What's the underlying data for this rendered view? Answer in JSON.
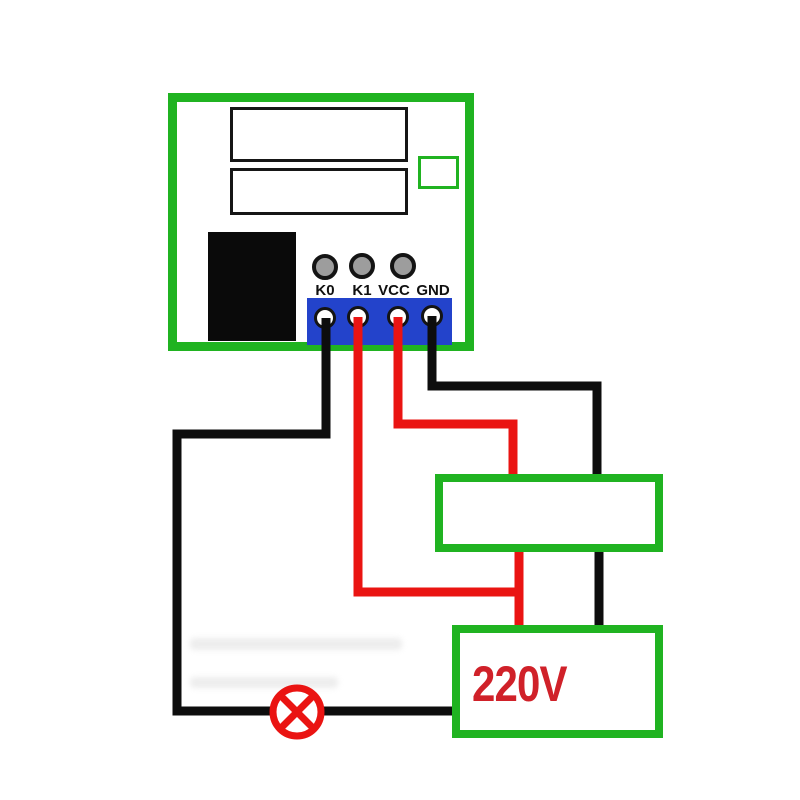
{
  "colors": {
    "board_green": "#20b321",
    "terminal_blue": "#2343cb",
    "wire_red": "#ea1412",
    "wire_black": "#0d0d0d",
    "text_red": "#d02129",
    "component_black": "#0a0a0a",
    "hole_gray": "#9d9d9d"
  },
  "module": {
    "terminals": [
      {
        "label": "K0",
        "wire_color": "black"
      },
      {
        "label": "K1",
        "wire_color": "red"
      },
      {
        "label": "VCC",
        "wire_color": "red"
      },
      {
        "label": "GND",
        "wire_color": "black"
      }
    ]
  },
  "power_source": {
    "label": "220V"
  },
  "icons": {
    "lamp": "lamp-circle-cross-icon"
  }
}
